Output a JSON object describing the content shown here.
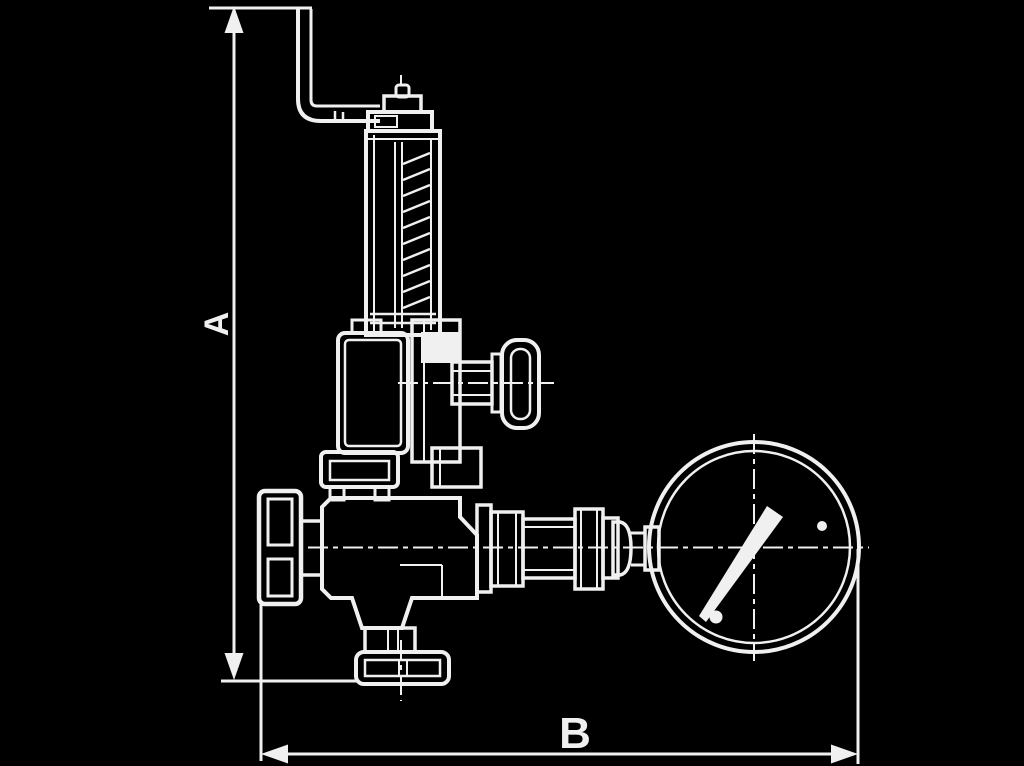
{
  "page": {
    "background_color": "#000000",
    "line_color": "#f0f0f0",
    "canvas": {
      "width": 1024,
      "height": 766
    }
  },
  "drawing": {
    "type": "technical-dimensional-diagram",
    "subject": "pressure relief valve with mounting bracket and pressure gauge, outline side view",
    "dimension_labels": {
      "vertical": "A",
      "horizontal": "B"
    }
  }
}
